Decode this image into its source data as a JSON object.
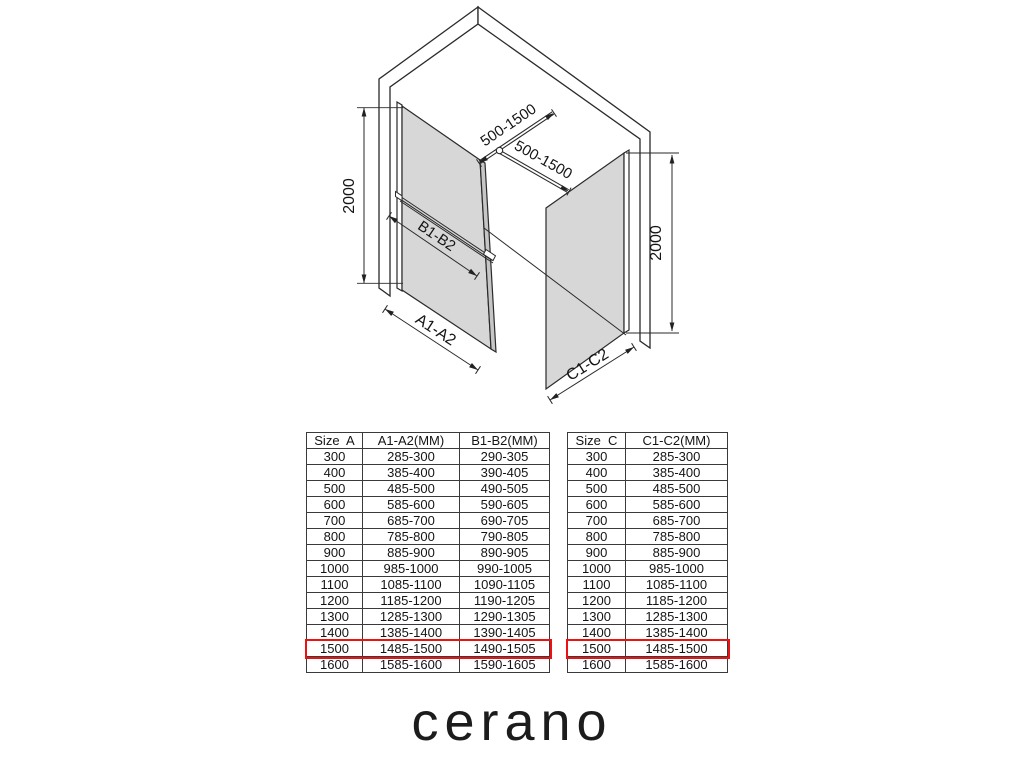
{
  "diagram": {
    "labels": {
      "height_left": "2000",
      "height_right": "2000",
      "support_bar_1": "500-1500",
      "support_bar_2": "500-1500",
      "mid_bar": "B1-B2",
      "panel_left_width": "A1-A2",
      "panel_right_width": "C1-C2"
    },
    "colors": {
      "glass": "#d7d7d7",
      "glass_edge": "#c6c6c6",
      "line": "#2a2a2a",
      "highlight": "#ed1111"
    }
  },
  "tables": {
    "left": {
      "headers": [
        "Size  A",
        "A1-A2(MM)",
        "B1-B2(MM)"
      ],
      "rows": [
        [
          "300",
          "285-300",
          "290-305"
        ],
        [
          "400",
          "385-400",
          "390-405"
        ],
        [
          "500",
          "485-500",
          "490-505"
        ],
        [
          "600",
          "585-600",
          "590-605"
        ],
        [
          "700",
          "685-700",
          "690-705"
        ],
        [
          "800",
          "785-800",
          "790-805"
        ],
        [
          "900",
          "885-900",
          "890-905"
        ],
        [
          "1000",
          "985-1000",
          "990-1005"
        ],
        [
          "1100",
          "1085-1100",
          "1090-1105"
        ],
        [
          "1200",
          "1185-1200",
          "1190-1205"
        ],
        [
          "1300",
          "1285-1300",
          "1290-1305"
        ],
        [
          "1400",
          "1385-1400",
          "1390-1405"
        ],
        [
          "1500",
          "1485-1500",
          "1490-1505"
        ],
        [
          "1600",
          "1585-1600",
          "1590-1605"
        ]
      ],
      "highlighted_size": "1500"
    },
    "right": {
      "headers": [
        "Size  C",
        "C1-C2(MM)"
      ],
      "rows": [
        [
          "300",
          "285-300"
        ],
        [
          "400",
          "385-400"
        ],
        [
          "500",
          "485-500"
        ],
        [
          "600",
          "585-600"
        ],
        [
          "700",
          "685-700"
        ],
        [
          "800",
          "785-800"
        ],
        [
          "900",
          "885-900"
        ],
        [
          "1000",
          "985-1000"
        ],
        [
          "1100",
          "1085-1100"
        ],
        [
          "1200",
          "1185-1200"
        ],
        [
          "1300",
          "1285-1300"
        ],
        [
          "1400",
          "1385-1400"
        ],
        [
          "1500",
          "1485-1500"
        ],
        [
          "1600",
          "1585-1600"
        ]
      ],
      "highlighted_size": "1500"
    }
  },
  "brand": {
    "logo_text": "cerano"
  }
}
